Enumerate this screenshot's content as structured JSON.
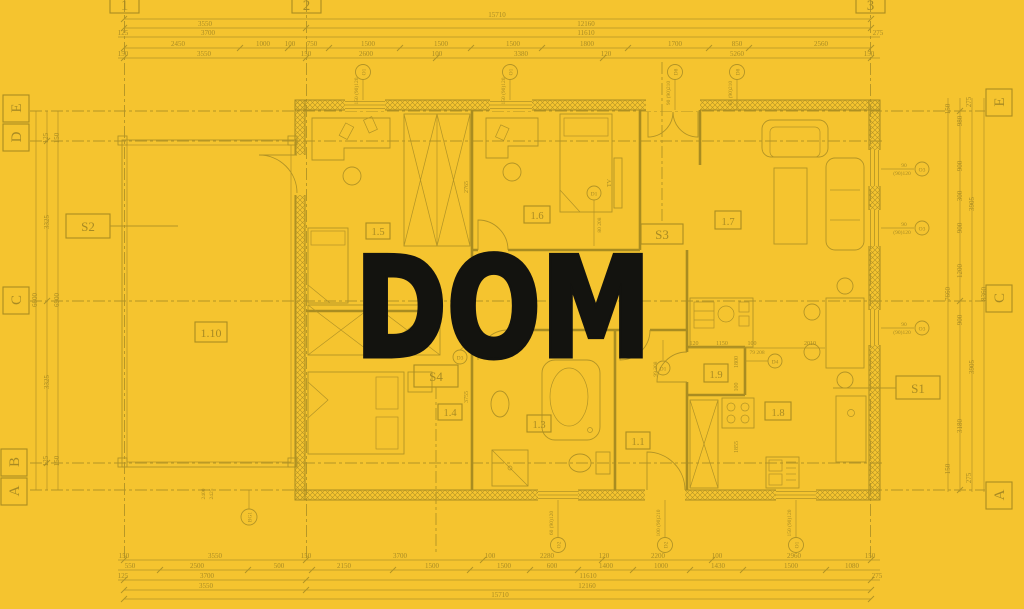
{
  "meta": {
    "title": "DOM"
  },
  "colors": {
    "background": "#F5C42F",
    "line": "#8A7620",
    "title": "#13130F"
  },
  "grid": {
    "cols": [
      "1",
      "2",
      "3"
    ],
    "left": [
      "E",
      "D",
      "C",
      "B",
      "A"
    ],
    "right": [
      "E",
      "C",
      "A"
    ]
  },
  "rooms": {
    "r15": "1.5",
    "r16": "1.6",
    "r17": "1.7",
    "r110": "1.10",
    "r14": "1.4",
    "r13": "1.3",
    "r11": "1.1",
    "r19": "1.9",
    "r18": "1.8"
  },
  "sections": {
    "s1": "S1",
    "s2": "S2",
    "s3": "S3",
    "s4": "S4"
  },
  "misc": {
    "tv": "TV"
  },
  "dims": {
    "top": {
      "total": "15710",
      "row1": [
        "3550",
        "12160"
      ],
      "row2": [
        "125",
        "3700",
        "11610",
        "275"
      ],
      "row3": [
        "2450",
        "1000",
        "100",
        "750",
        "1500",
        "1500",
        "1500",
        "1800",
        "1700",
        "850",
        "2560"
      ],
      "row4": [
        "150",
        "3550",
        "150",
        "2600",
        "100",
        "3380",
        "120",
        "5260",
        "150"
      ]
    },
    "bottom": {
      "row1": [
        "150",
        "3550",
        "150",
        "3700",
        "100",
        "2280",
        "120",
        "2200",
        "100",
        "2960",
        "150"
      ],
      "row2": [
        "550",
        "2500",
        "500",
        "2150",
        "1500",
        "1500",
        "600",
        "1400",
        "1000",
        "1430",
        "1500",
        "1080"
      ],
      "row3": [
        "125",
        "3700",
        "11610",
        "275"
      ],
      "row4": [
        "3550",
        "12160"
      ],
      "total": "15710"
    },
    "left": [
      "125",
      "150",
      "3325",
      "6600",
      "6900",
      "3325",
      "125",
      "150"
    ],
    "right": [
      "150",
      "275",
      "980",
      "900",
      "300",
      "3905",
      "900",
      "1200",
      "7660",
      "8360",
      "900",
      "3905",
      "3180",
      "150",
      "275"
    ],
    "inner": [
      "2765",
      "3755",
      "120",
      "1150",
      "100",
      "2010",
      "1800",
      "100",
      "1855",
      "2400",
      "2425",
      "99 208",
      "79 208",
      "80 208"
    ]
  },
  "tags": {
    "o1": "O1",
    "o2": "O2",
    "o3": "O3",
    "d1": "D1",
    "d2": "D2",
    "d3": "D3",
    "d4": "D4",
    "d8": "D8",
    "bg1": "BG1",
    "notes": {
      "n150": "150 (90)120",
      "n90": "90",
      "n90_120": "(90)120",
      "n90_210": "90 (90)210",
      "n85_210": "85 (90)210",
      "n60": "60 (90)120",
      "n100": "100 (90)210"
    }
  }
}
